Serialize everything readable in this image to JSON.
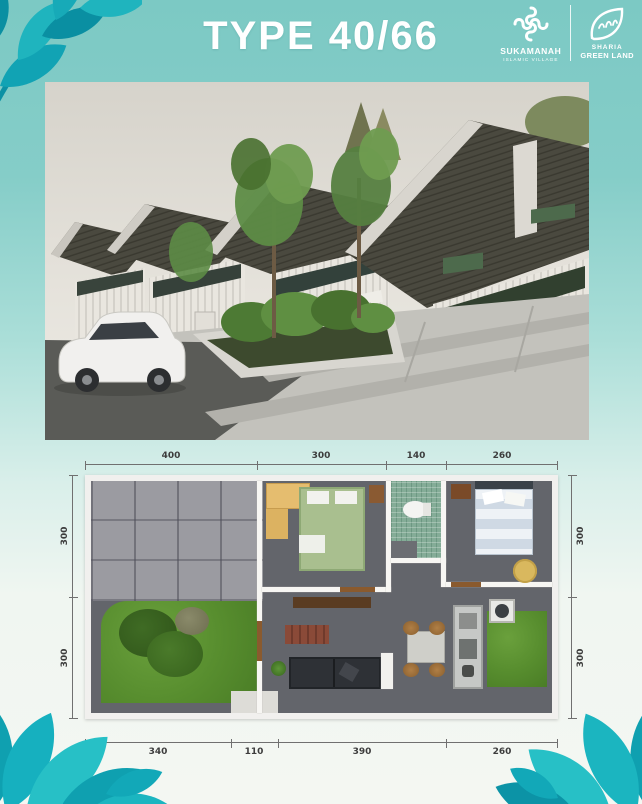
{
  "header": {
    "title": "TYPE 40/66",
    "logo_sukamanah": {
      "name": "SUKAMANAH",
      "tagline": "ISLAMIC VILLAGE"
    },
    "logo_sharia": {
      "line1": "SHARIA",
      "line2": "GREEN LAND"
    }
  },
  "floor_plan": {
    "top": [
      "400",
      "300",
      "140",
      "260"
    ],
    "bottom": [
      "340",
      "110",
      "390",
      "260"
    ],
    "left": [
      "300",
      "300"
    ],
    "right": [
      "300",
      "300"
    ]
  },
  "colors": {
    "background_teal": "#7cc9c4",
    "leaf_teal": "#14a7b6",
    "title_white": "#ffffff",
    "roof_dark": "#47463e",
    "plan_floor_gray": "#63656b",
    "plan_grass_green": "#578d2e"
  }
}
